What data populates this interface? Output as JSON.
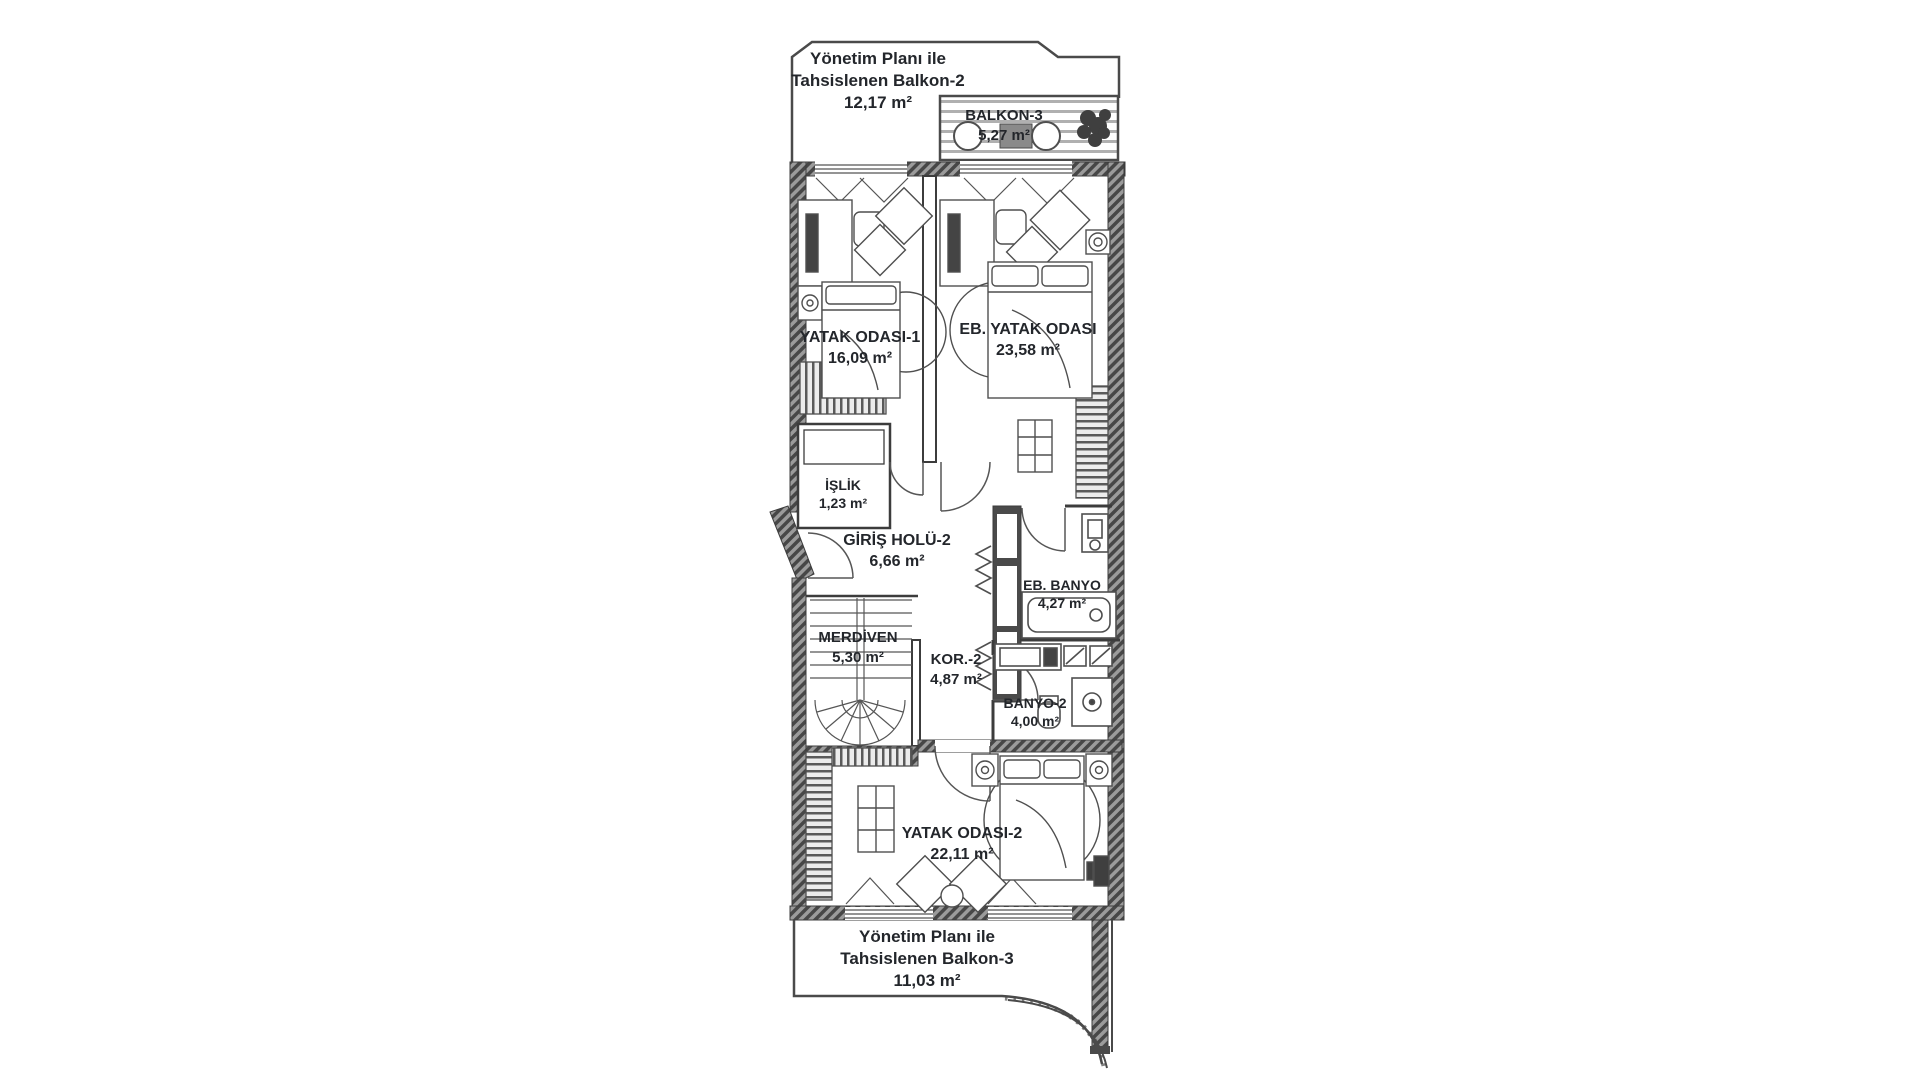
{
  "colors": {
    "wall": "#4a4a4a",
    "line": "#4f4f4f",
    "text": "#23262b"
  },
  "rooms": {
    "balkon2": {
      "line1": "Yönetim Planı ile",
      "line2": "Tahsislenen Balkon-2",
      "area": "12,17 m²"
    },
    "balkon3": {
      "name": "BALKON-3",
      "area": "5,27 m²"
    },
    "yatak1": {
      "name": "YATAK ODASI-1",
      "area": "16,09 m²"
    },
    "eb_yatak": {
      "name": "EB. YATAK ODASI",
      "area": "23,58 m²"
    },
    "islik": {
      "name": "İŞLİK",
      "area": "1,23 m²"
    },
    "giris_holu": {
      "name": "GİRİŞ HOLÜ-2",
      "area": "6,66 m²"
    },
    "merdiven": {
      "name": "MERDİVEN",
      "area": "5,30 m²"
    },
    "kor2": {
      "name": "KOR.-2",
      "area": "4,87 m²"
    },
    "eb_banyo": {
      "name": "EB. BANYO",
      "area": "4,27 m²"
    },
    "banyo2": {
      "name": "BANYO-2",
      "area": "4,00 m²"
    },
    "yatak2": {
      "name": "YATAK ODASI-2",
      "area": "22,11 m²"
    },
    "balkon3_alt": {
      "line1": "Yönetim Planı ile",
      "line2": "Tahsislenen Balkon-3",
      "area": "11,03 m²"
    }
  }
}
